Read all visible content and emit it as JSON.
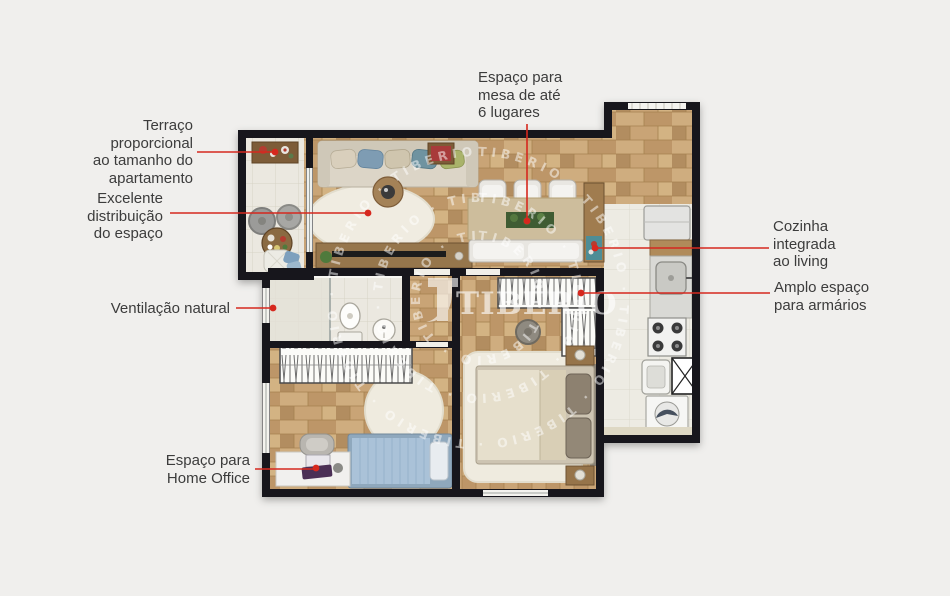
{
  "colors": {
    "accent": "#d6281e",
    "label": "#3c3c3c",
    "wall": "#17161c",
    "wood": "#c6a173",
    "tile": "#ebe8e0"
  },
  "watermark": {
    "logo_text": "TIBÉRIO",
    "ring_word": "TIBERIO"
  },
  "labels": {
    "terrace": {
      "lines": [
        "Terraço",
        "proporcional",
        "ao tamanho do",
        "apartamento"
      ]
    },
    "distribution": {
      "lines": [
        "Excelente",
        "distribuição",
        "do espaço"
      ]
    },
    "ventilation": {
      "lines": [
        "Ventilação natural"
      ]
    },
    "home_office": {
      "lines": [
        "Espaço para",
        "Home Office"
      ]
    },
    "dining": {
      "lines": [
        "Espaço para",
        "mesa de até",
        "6 lugares"
      ]
    },
    "kitchen": {
      "lines": [
        "Cozinha",
        "integrada",
        "ao living"
      ]
    },
    "closets": {
      "lines": [
        "Amplo espaço",
        "para armários"
      ]
    }
  }
}
